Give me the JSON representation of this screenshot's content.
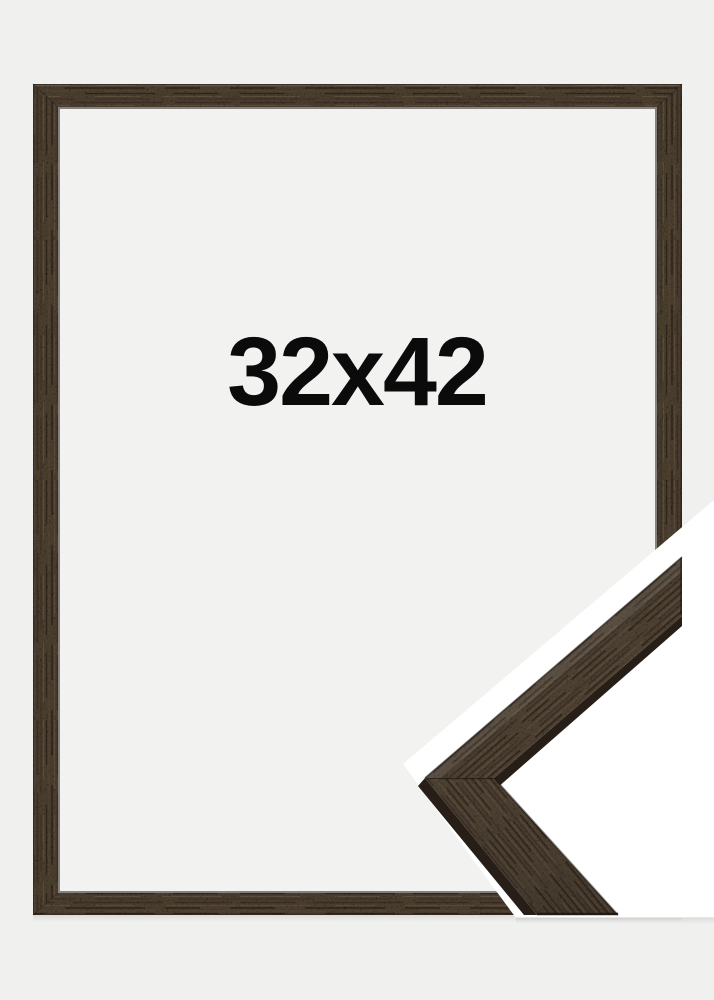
{
  "product": {
    "size_label": "32x42"
  },
  "colors": {
    "background": "#f0f0ee",
    "frame_interior": "#f2f2f1",
    "overlay_white": "#ffffff",
    "wood_base": "#493c2f",
    "wood_streak_dark": "#33291f",
    "wood_streak_light": "#5a4b3b",
    "wood_side_face": "#271f17",
    "size_text": "#0b0b0b"
  }
}
